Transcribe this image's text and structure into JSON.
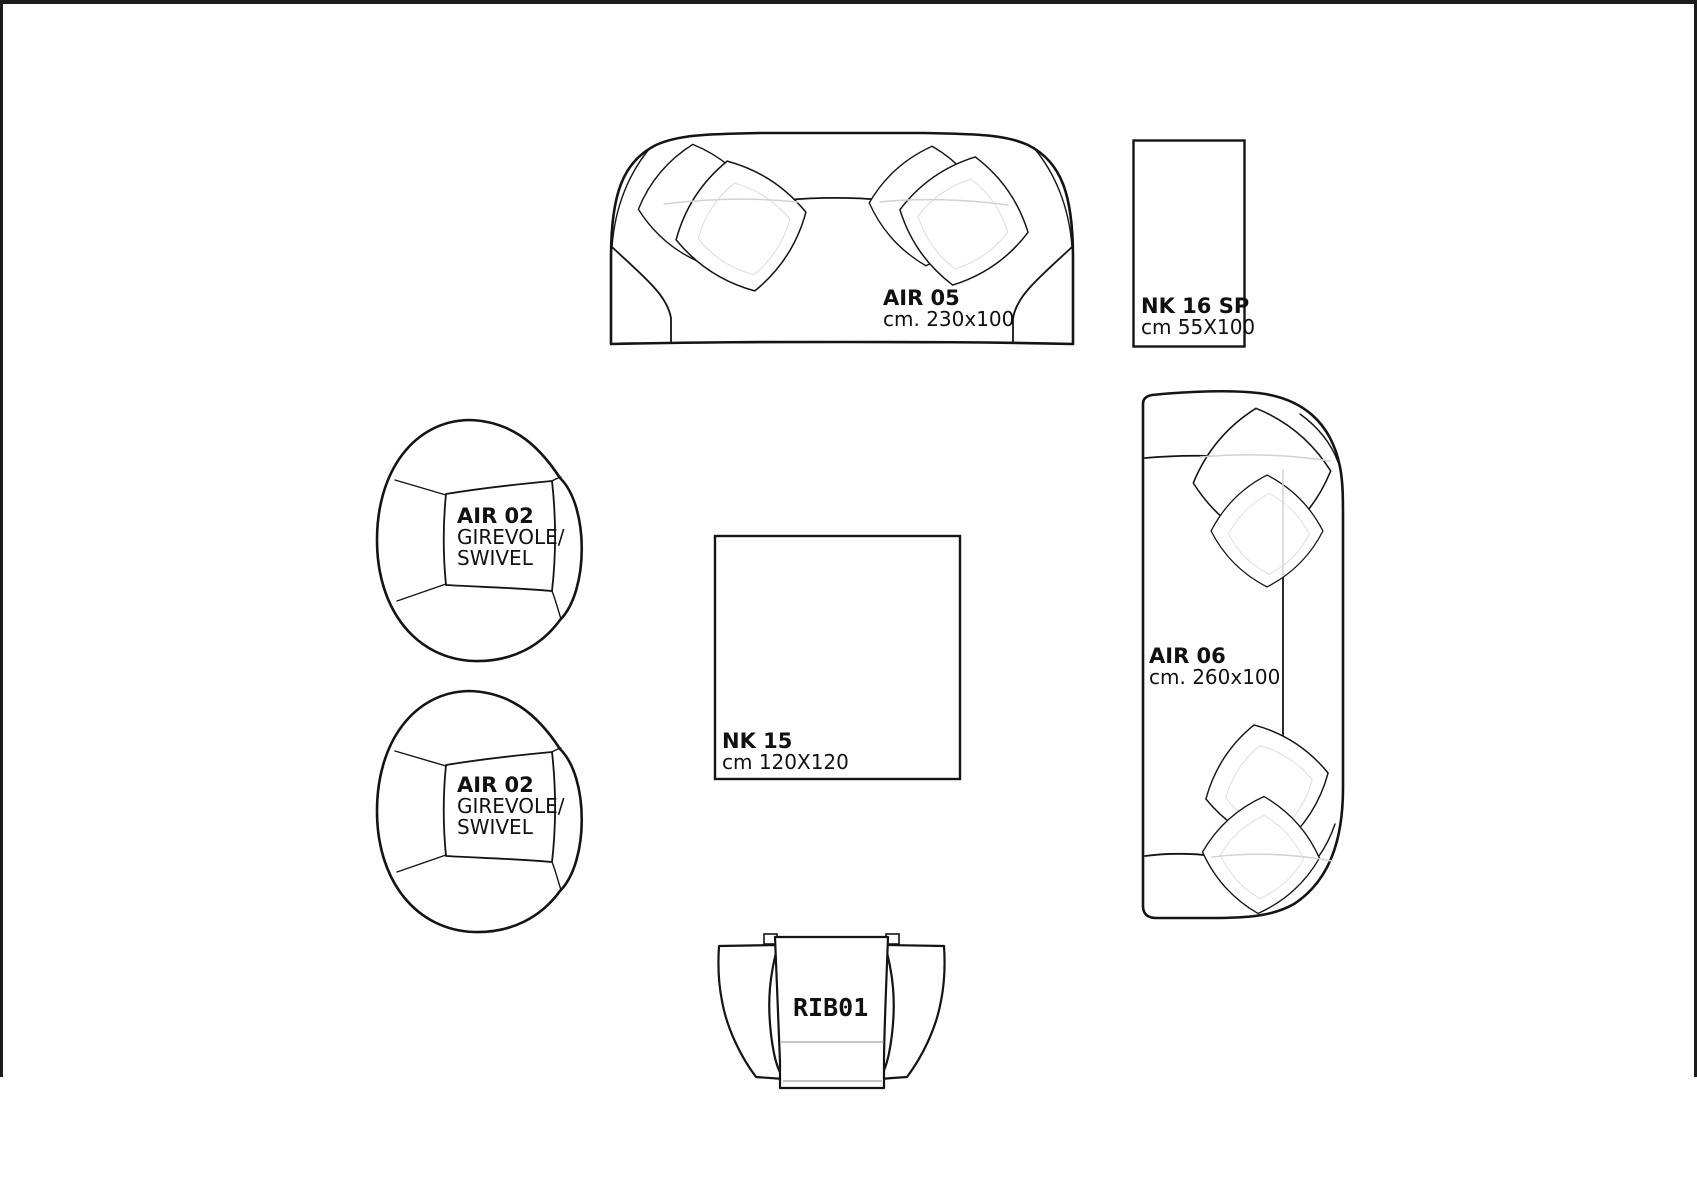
{
  "drawing": {
    "background_color": "#ffffff",
    "line_color": "#141414",
    "hidden_line_color": "#d2d2d2",
    "items": {
      "air05": {
        "name": "AIR 05",
        "dims": "cm. 230x100"
      },
      "nk16sp": {
        "name": "NK 16 SP",
        "dims": "cm 55X100"
      },
      "air02_top": {
        "name": "AIR 02",
        "type_line1": "GIREVOLE/",
        "type_line2": "SWIVEL"
      },
      "air02_bottom": {
        "name": "AIR 02",
        "type_line1": "GIREVOLE/",
        "type_line2": "SWIVEL"
      },
      "nk15": {
        "name": "NK 15",
        "dims": "cm 120X120"
      },
      "air06": {
        "name": "AIR 06",
        "dims": "cm. 260x100"
      },
      "rib01": {
        "name": "RIB01"
      }
    }
  }
}
